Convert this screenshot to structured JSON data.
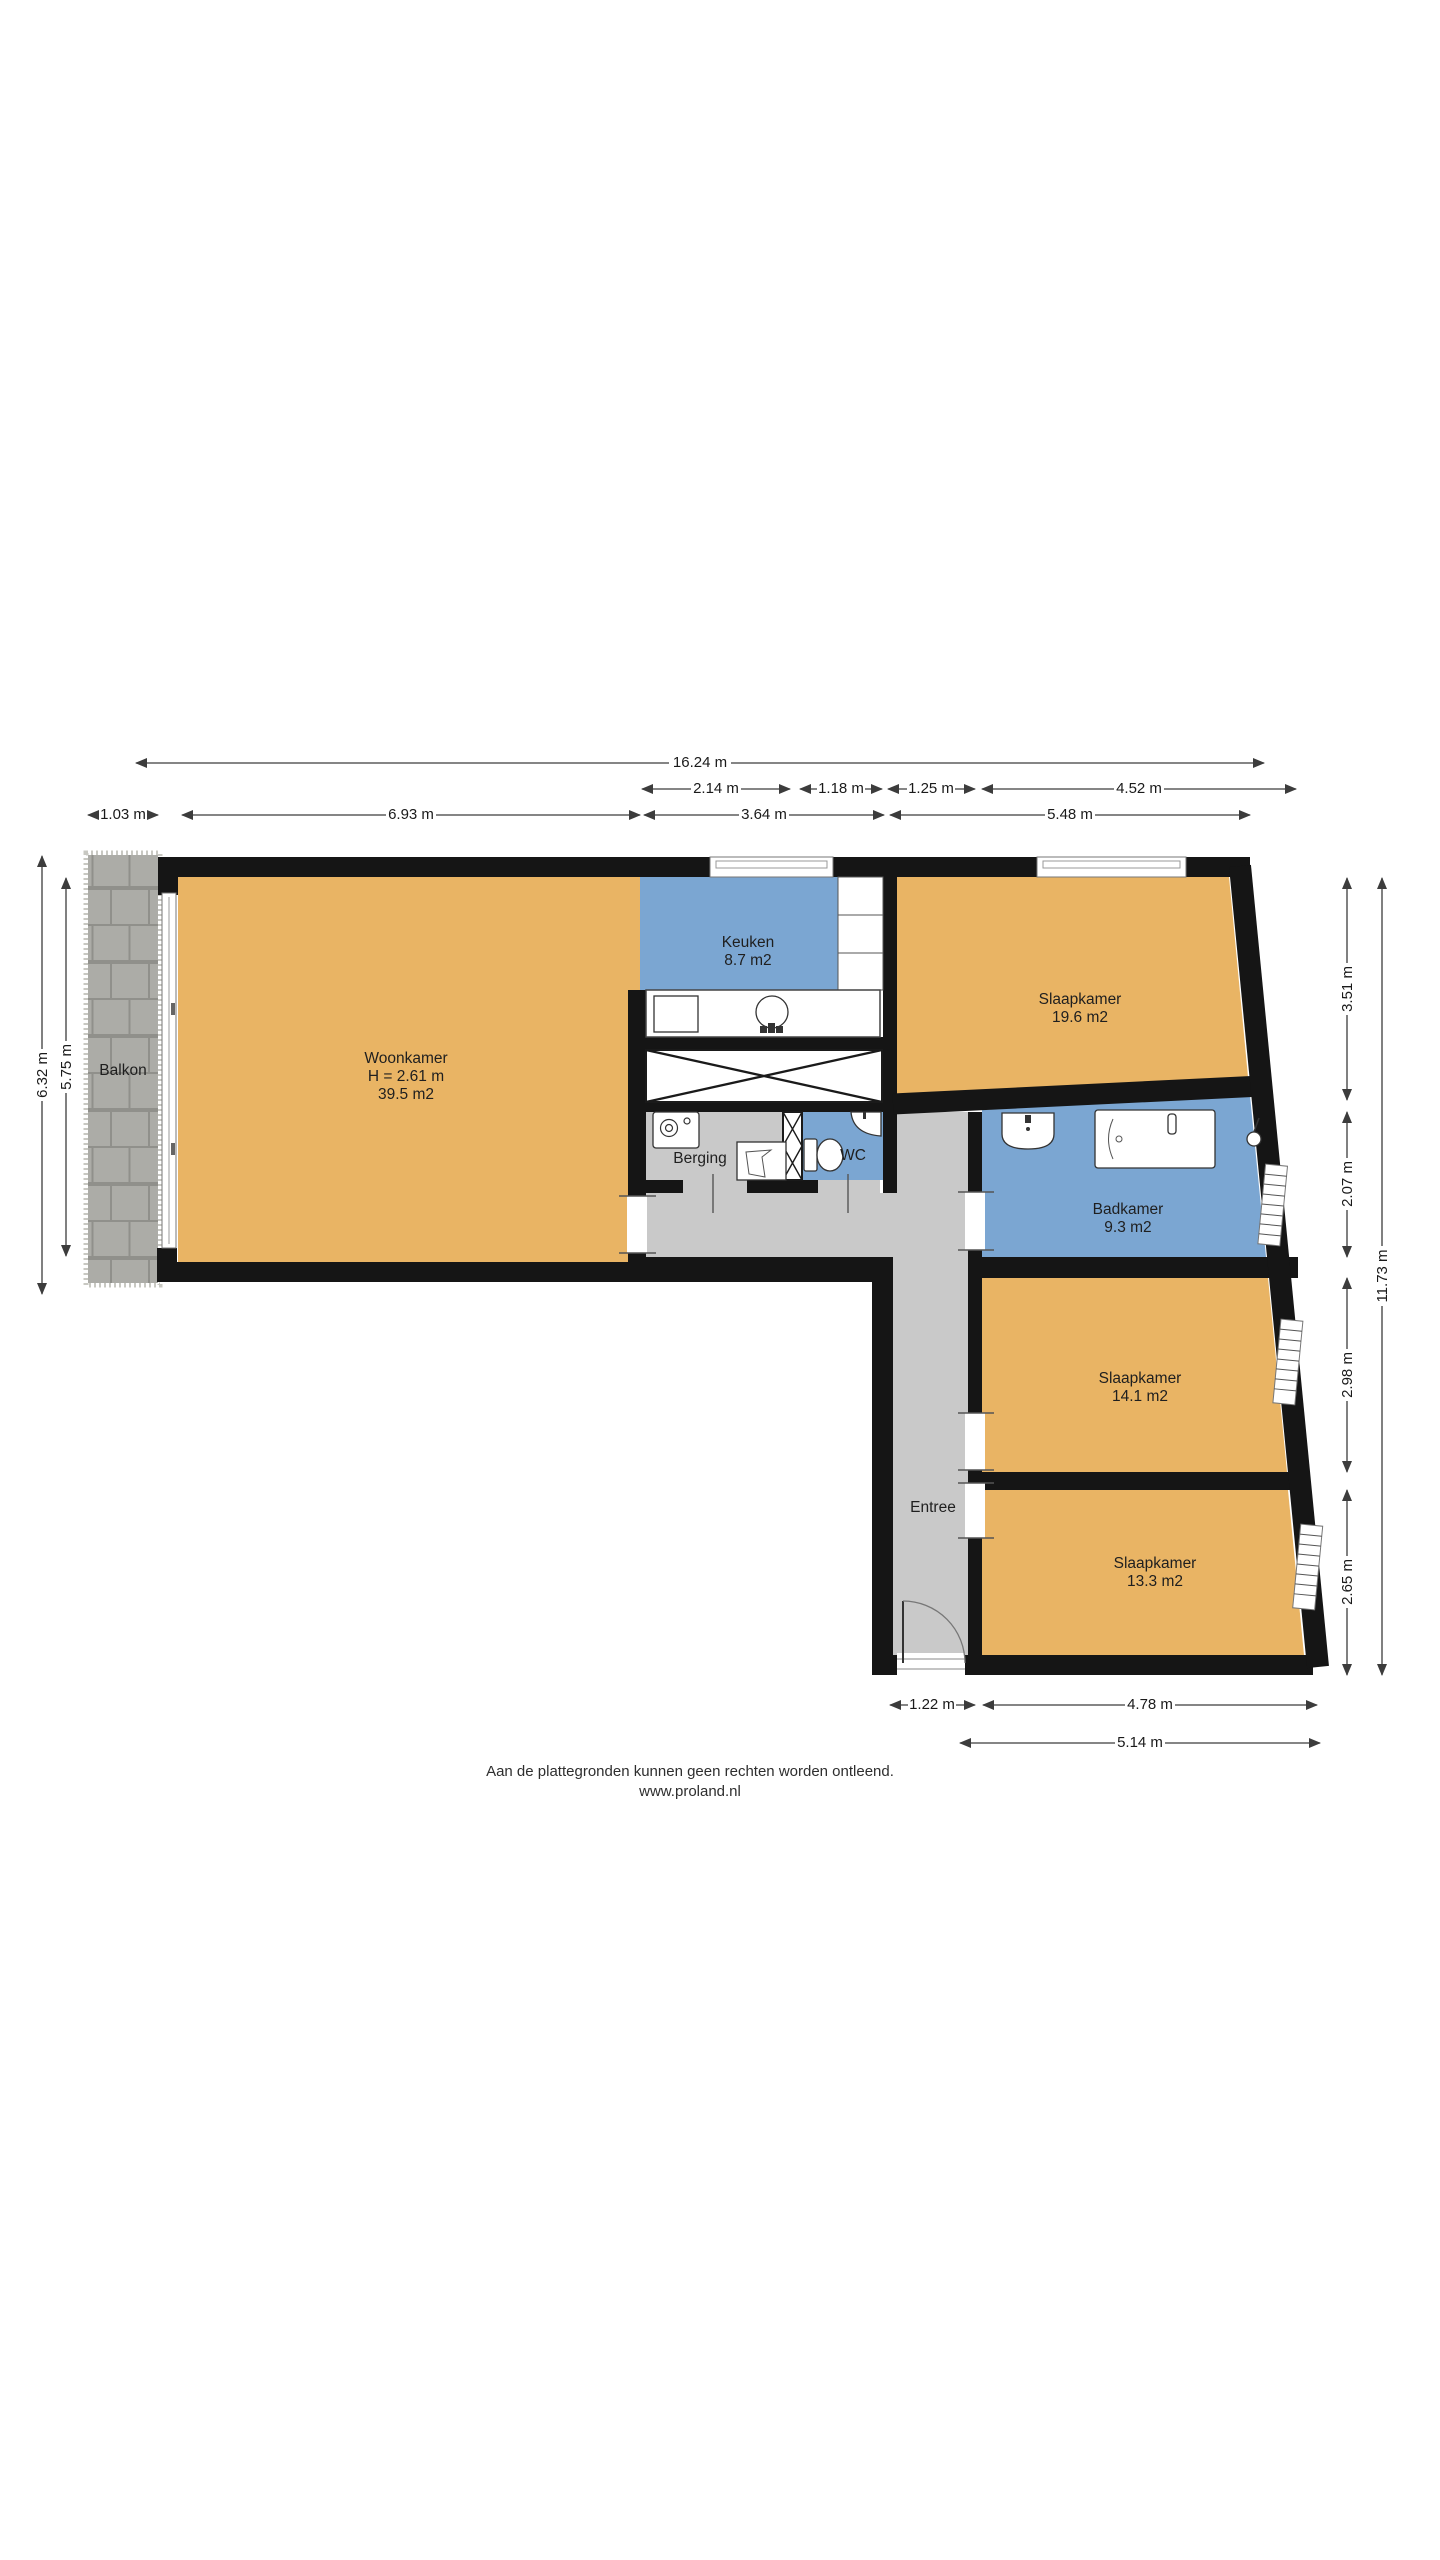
{
  "title": "Floor plan (plattegrond)",
  "colors": {
    "floor_orange": "#E9B464",
    "floor_blue": "#7BA6D2",
    "floor_gray": "#C9C9C9",
    "balkon_tile": "#ACACA7",
    "wall": "#151515"
  },
  "rooms": {
    "woonkamer": {
      "name": "Woonkamer",
      "ceiling_height": "H = 2.61 m",
      "area": "39.5 m2"
    },
    "keuken": {
      "name": "Keuken",
      "area": "8.7 m2"
    },
    "slaapkamer_1": {
      "name": "Slaapkamer",
      "area": "19.6 m2"
    },
    "badkamer": {
      "name": "Badkamer",
      "area": "9.3 m2"
    },
    "slaapkamer_2": {
      "name": "Slaapkamer",
      "area": "14.1 m2"
    },
    "slaapkamer_3": {
      "name": "Slaapkamer",
      "area": "13.3 m2"
    },
    "berging": {
      "name": "Berging"
    },
    "wc": {
      "name": "WC"
    },
    "entree": {
      "name": "Entree"
    },
    "balkon": {
      "name": "Balkon"
    }
  },
  "dimensions": {
    "top_total": "16.24 m",
    "top_row2": [
      "2.14 m",
      "1.18 m",
      "1.25 m",
      "4.52 m"
    ],
    "top_row3": [
      "1.03 m",
      "6.93 m",
      "3.64 m",
      "5.48 m"
    ],
    "left": [
      "6.32 m",
      "5.75 m"
    ],
    "right": [
      "3.51 m",
      "2.07 m",
      "2.98 m",
      "2.65 m",
      "11.73 m"
    ],
    "bottom": [
      "1.22 m",
      "4.78 m",
      "5.14 m"
    ]
  },
  "icons": {
    "kitchen": [
      "stove-icon",
      "kitchen-sink-icon",
      "cabinet-icon"
    ],
    "berging": [
      "washing-machine-icon",
      "laundry-tub-icon"
    ],
    "wc": [
      "toilet-icon",
      "corner-sink-icon"
    ],
    "badkamer": [
      "washbasin-icon",
      "bathtub-icon",
      "shower-icon"
    ],
    "entree": [
      "front-door-icon"
    ],
    "shafts": [
      "crossed-void-icon",
      "duct-icon"
    ]
  },
  "footer": {
    "disclaimer": "Aan de plattegronden kunnen geen rechten worden ontleend.",
    "website": "www.proland.nl"
  }
}
